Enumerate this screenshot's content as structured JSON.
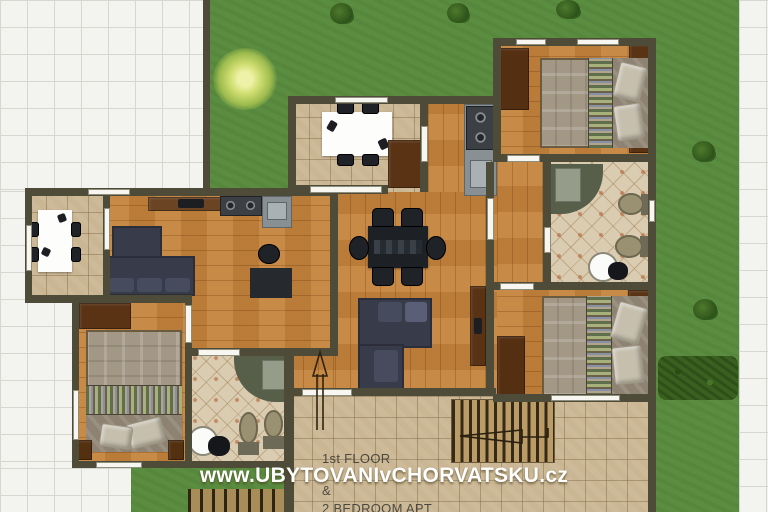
{
  "watermark": {
    "text": "www.UBYTOVANIvCHORVATSKU.cz"
  },
  "floor_label": {
    "line1": "1st FLOOR",
    "line2": "&",
    "line3": "2 BEDROOM APT"
  },
  "icons": {
    "entrance_arrow": "arrow-up",
    "stairs_arrow": "arrow-left"
  },
  "colors": {
    "grass": "#5a8d40",
    "hedge": "#39601f",
    "wall": "#4e4b39",
    "wood_floor": "#c5843c",
    "terrace_tile": "#cab693",
    "patio_tile": "#f3f3f0",
    "bath_tile": "#d9ccb1",
    "sofa": "#383b4a",
    "furniture_wood": "#5a3315",
    "stairs": "#bb9c66",
    "watermark_text": "#ffffff",
    "floor_label_text": "#3e3e36"
  }
}
